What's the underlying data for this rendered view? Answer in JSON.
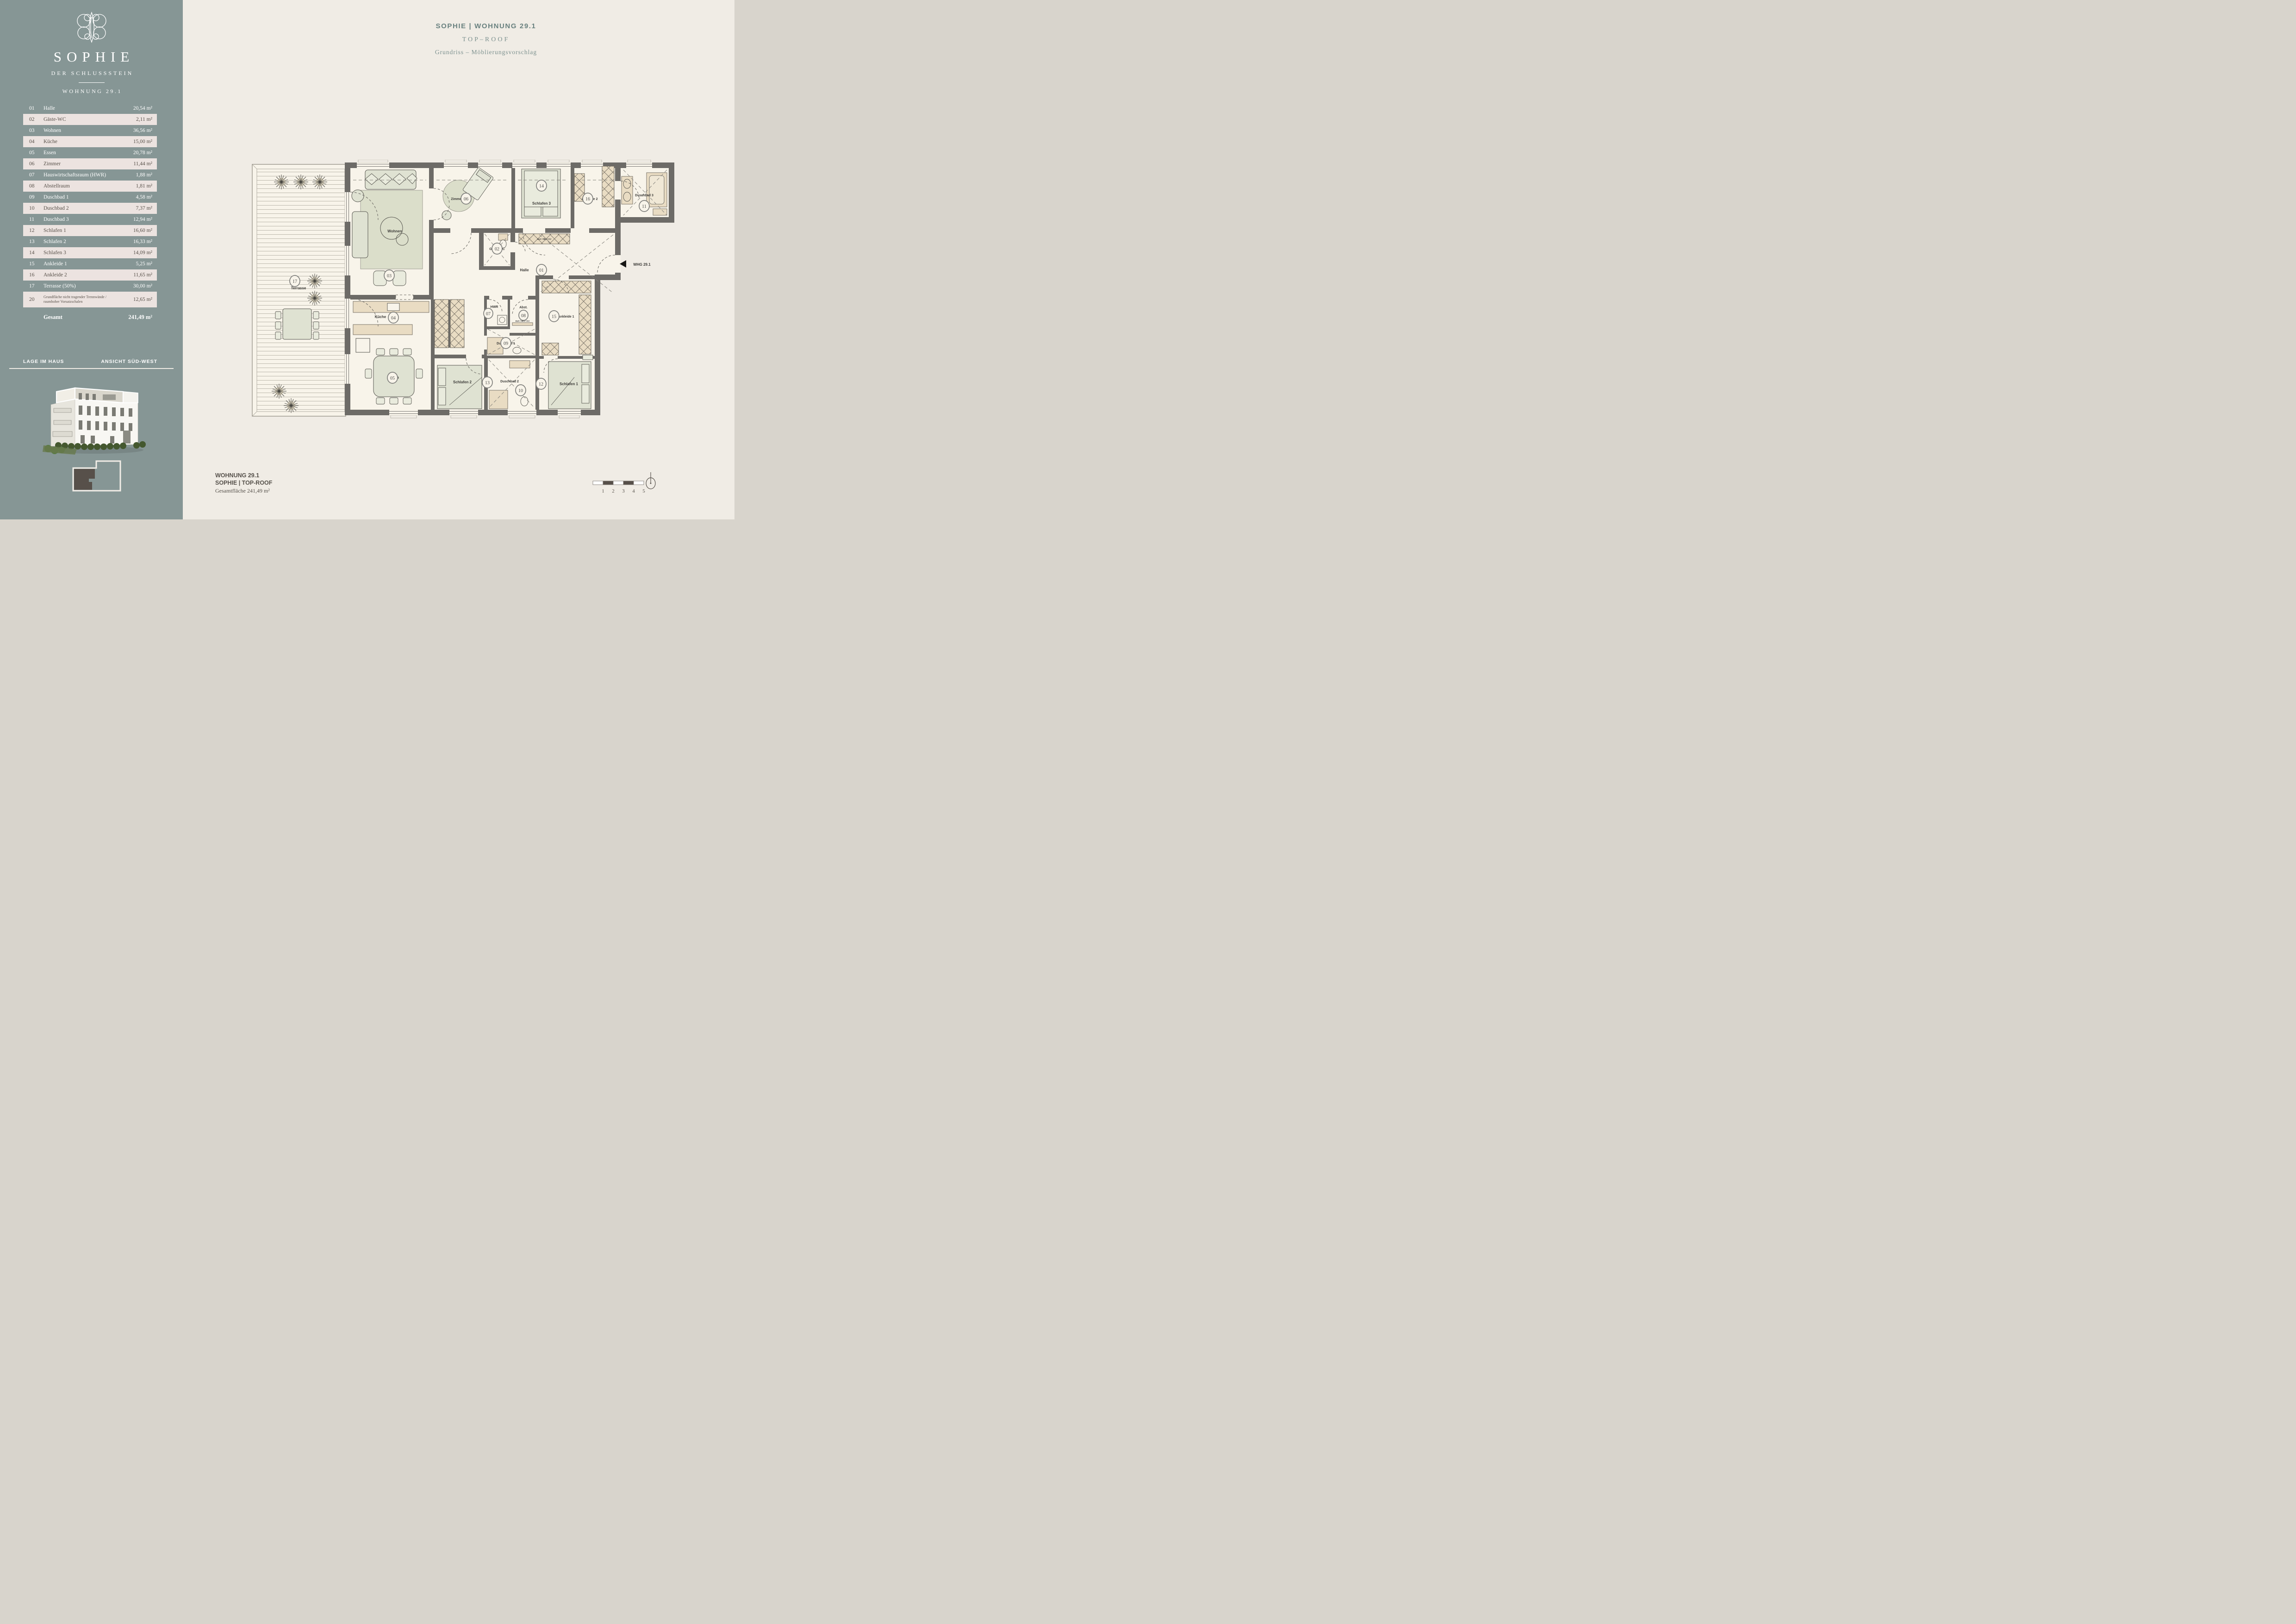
{
  "sidebar": {
    "logo": {
      "name": "SOPHIE",
      "subtitle": "DER SCHLUSSSTEIN",
      "unit": "WOHNUNG 29.1"
    },
    "table": {
      "rows": [
        {
          "num": "01",
          "name": "Halle",
          "area": "20,54 m²"
        },
        {
          "num": "02",
          "name": "Gäste-WC",
          "area": "2,11 m²"
        },
        {
          "num": "03",
          "name": "Wohnen",
          "area": "36,56 m²"
        },
        {
          "num": "04",
          "name": "Küche",
          "area": "15,00 m²"
        },
        {
          "num": "05",
          "name": "Essen",
          "area": "20,78 m²"
        },
        {
          "num": "06",
          "name": "Zimmer",
          "area": "11,44 m²"
        },
        {
          "num": "07",
          "name": "Hauswirtschaftsraum (HWR)",
          "area": "1,88 m²"
        },
        {
          "num": "08",
          "name": "Abstellraum",
          "area": "1,81 m²"
        },
        {
          "num": "09",
          "name": "Duschbad 1",
          "area": "4,58 m²"
        },
        {
          "num": "10",
          "name": "Duschbad 2",
          "area": "7,37 m²"
        },
        {
          "num": "11",
          "name": "Duschbad 3",
          "area": "12,94 m²"
        },
        {
          "num": "12",
          "name": "Schlafen 1",
          "area": "16,60 m²"
        },
        {
          "num": "13",
          "name": "Schlafen 2",
          "area": "16,33 m²"
        },
        {
          "num": "14",
          "name": "Schlafen 3",
          "area": "14,09 m²"
        },
        {
          "num": "15",
          "name": "Ankleide 1",
          "area": "5,25 m²"
        },
        {
          "num": "16",
          "name": "Ankleide 2",
          "area": "11,65 m²"
        },
        {
          "num": "17",
          "name": "Terrasse (50%)",
          "area": "30,00 m²"
        },
        {
          "num": "20",
          "name": "Grundfläche nicht tragender Trennwände /\nraumhoher Vorsatzschalen",
          "area": "12,65 m²"
        }
      ],
      "total_label": "Gesamt",
      "total_area": "241,49 m²"
    },
    "location": {
      "left": "LAGE IM HAUS",
      "right": "ANSICHT SÜD-WEST"
    }
  },
  "header": {
    "title": "SOPHIE | WOHNUNG 29.1",
    "subtitle": "TOP–ROOF",
    "line3": "Grundriss – Möblierungsvorschlag"
  },
  "footer": {
    "line1": "WOHNUNG 29.1",
    "line2": "SOPHIE | TOP-ROOF",
    "line3": "Gesamtfläche 241,49 m²"
  },
  "plan": {
    "rooms": {
      "terrasse": {
        "n": "17",
        "label": "Terrasse"
      },
      "wohnen": {
        "n": "03",
        "label": "Wohnen"
      },
      "zimmer": {
        "n": "06",
        "label": "Zimmer"
      },
      "schlafen3": {
        "n": "14",
        "label": "Schlafen 3"
      },
      "ankleide2": {
        "n": "16",
        "label": "Ankleide 2"
      },
      "duschbad3": {
        "n": "11",
        "label": "Duschbad 3"
      },
      "gwc": {
        "n": "02",
        "label": "Gäste-WC"
      },
      "halle": {
        "n": "01",
        "label": "Halle"
      },
      "kueche": {
        "n": "04",
        "label": "Küche"
      },
      "essen": {
        "n": "05",
        "label": "Essen"
      },
      "hwr": {
        "n": "07",
        "label": "HWR"
      },
      "abst": {
        "n": "08",
        "label": "Abst."
      },
      "duschbad1": {
        "n": "09",
        "label": "Duschbad 1"
      },
      "duschbad2": {
        "n": "10",
        "label": "Duschbad 2"
      },
      "schlafen2": {
        "n": "13",
        "label": "Schlafen 2"
      },
      "schlafen1": {
        "n": "12",
        "label": "Schlafen 1"
      },
      "ankleide1": {
        "n": "15",
        "label": "Ankleide 1"
      }
    },
    "entrance": "WHG 29.1",
    "cabinet": "EUV / HKV / KV"
  },
  "scale": {
    "labels": [
      "1",
      "2",
      "3",
      "4",
      "5"
    ]
  },
  "colors": {
    "sidebar": "#869695",
    "row_light": "#ece3e0",
    "main_bg": "#f0ece5",
    "wall": "#6d6b67",
    "accent_text": "#7c918f",
    "keyplan_fill": "#57504a"
  }
}
